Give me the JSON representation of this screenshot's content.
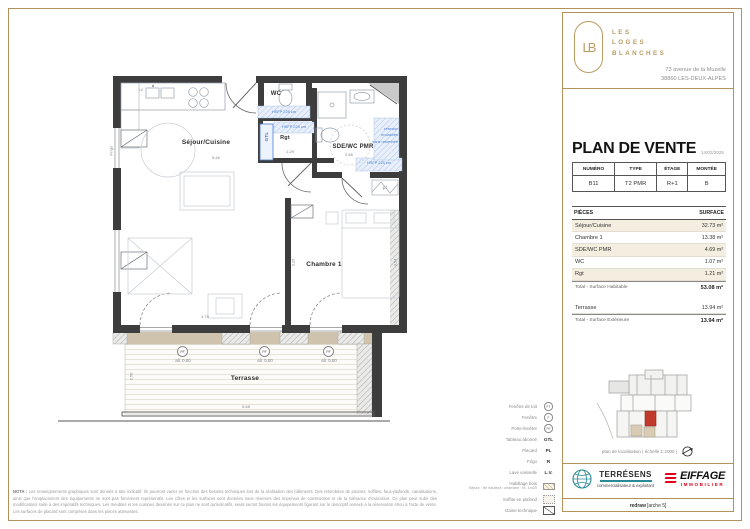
{
  "branding": {
    "monogram": "LB",
    "name_lines": [
      "LES",
      "LOGES",
      "BLANCHES"
    ],
    "address_line1": "73 avenue de la Muzelle",
    "address_line2": "38860 LES-DEUX-ALPES"
  },
  "header": {
    "title": "PLAN DE VENTE",
    "date": "14/02/2025"
  },
  "unit": {
    "headers": [
      "NUMÉRO",
      "TYPE",
      "ÉTAGE",
      "MONTÉE"
    ],
    "values": [
      "B11",
      "T2 PMR",
      "R+1",
      "B"
    ]
  },
  "surfaces": {
    "col_pieces": "PIÈCES",
    "col_surface": "SURFACE",
    "rows": [
      {
        "label": "Séjour/Cuisine",
        "value": "32.73 m²"
      },
      {
        "label": "Chambre 1",
        "value": "13.38 m²"
      },
      {
        "label": "SDE/WC PMR",
        "value": "4.69 m²"
      },
      {
        "label": "WC",
        "value": "1.07 m²"
      },
      {
        "label": "Rgt",
        "value": "1.21 m²"
      }
    ],
    "total_habitable": {
      "label": "Total - Surface Habitable",
      "value": "53.08 m²"
    },
    "terrasse": {
      "label": "Terrasse",
      "value": "13.94 m²"
    },
    "total_exterieure": {
      "label": "Total - Surface Extérieure",
      "value": "13.94 m²"
    }
  },
  "locator": {
    "caption": "plan de localisation | échelle 1:2000 |"
  },
  "plan": {
    "rooms": {
      "sejour": "Séjour/Cuisine",
      "wc": "WC",
      "rgt": "Rgt",
      "sde": "SDE/WC PMR",
      "chambre": "Chambre 1",
      "terrasse": "Terrasse"
    },
    "labels": {
      "frigo": "Frigo",
      "pl": "pl",
      "lv": "LV",
      "gtl": "GTL"
    },
    "annotations": {
      "hsfp": "HSFP 225 cm",
      "radiateur_l1": "réseaux",
      "radiateur_l2": "encastrés",
      "radiateur_l3": "sans retombée"
    },
    "openings": {
      "pf": "PF",
      "allege": "all. 0.00"
    },
    "dims": {
      "sejour_w": "5.46",
      "sejour_b": "4.75",
      "rgt_w": "1.29",
      "sde_w": "2.66",
      "chambre_l": "3.15",
      "chambre_r": "3.54",
      "terrasse_d": "2.50",
      "terrasse_w": "5.48"
    }
  },
  "legend": {
    "items": [
      {
        "label": "Fenêtre de toit",
        "symbol": "FT"
      },
      {
        "label": "Fenêtre",
        "symbol": "F"
      },
      {
        "label": "Porte-fenêtre",
        "symbol": "PF"
      },
      {
        "label": "Tableau abonné",
        "symbol": "GTL"
      },
      {
        "label": "Placard",
        "symbol": "PL"
      },
      {
        "label": "Frigo",
        "symbol": "R"
      },
      {
        "label": "Lave vaisselle",
        "symbol": "L.V."
      },
      {
        "label": "Habillage bois",
        "sublabel": "Séjour : tte hauteur / chambre : ht. 1m20"
      },
      {
        "label": "Soffite en plafond"
      },
      {
        "label": "Gaine technique"
      }
    ]
  },
  "nota": {
    "prefix": "NOTA :",
    "body": " Les renseignements graphiques sont donnés à titre indicatif. Ils pourront varier en fonction des besoins techniques lors de la réalisation des bâtiments. Des retombées de poutres, soffites, faux-plafonds, canalisations, ainsi que l'emplacement des équipements ne sont pas forcément représentés. Les côtes et les surfaces sont données sous réserves des imprévus de construction et de la tolérance d'exécution. Ce plan peut subir des modifications suite à des impératifs techniques. Les meubles et les cuisines dessinés sur ce plan ne sont qu'indicatifs, seuls seront fournis les équipements figurant sur le descriptif annexé à la réservation et/ou à l'acte de vente. Les surfaces de placard sont comprises dans les pièces attenantes."
  },
  "partners": {
    "terresens": {
      "name": "TERRÉSENS",
      "tagline": "commercialisateur & exploitant"
    },
    "eiffage": {
      "name": "EIFFAGE",
      "division": "IMMOBILIER"
    }
  },
  "footer": {
    "bold": "redraw",
    "rest": "[arche 5]"
  },
  "colors": {
    "gold": "#b2925a",
    "accent_blue": "#4a7ed0",
    "unit_red": "#c0392b",
    "eiffage_red": "#e2001a",
    "terresens_teal": "#2a8a96",
    "wall": "#3d3d3d",
    "row_shade": "#f4eee0"
  }
}
